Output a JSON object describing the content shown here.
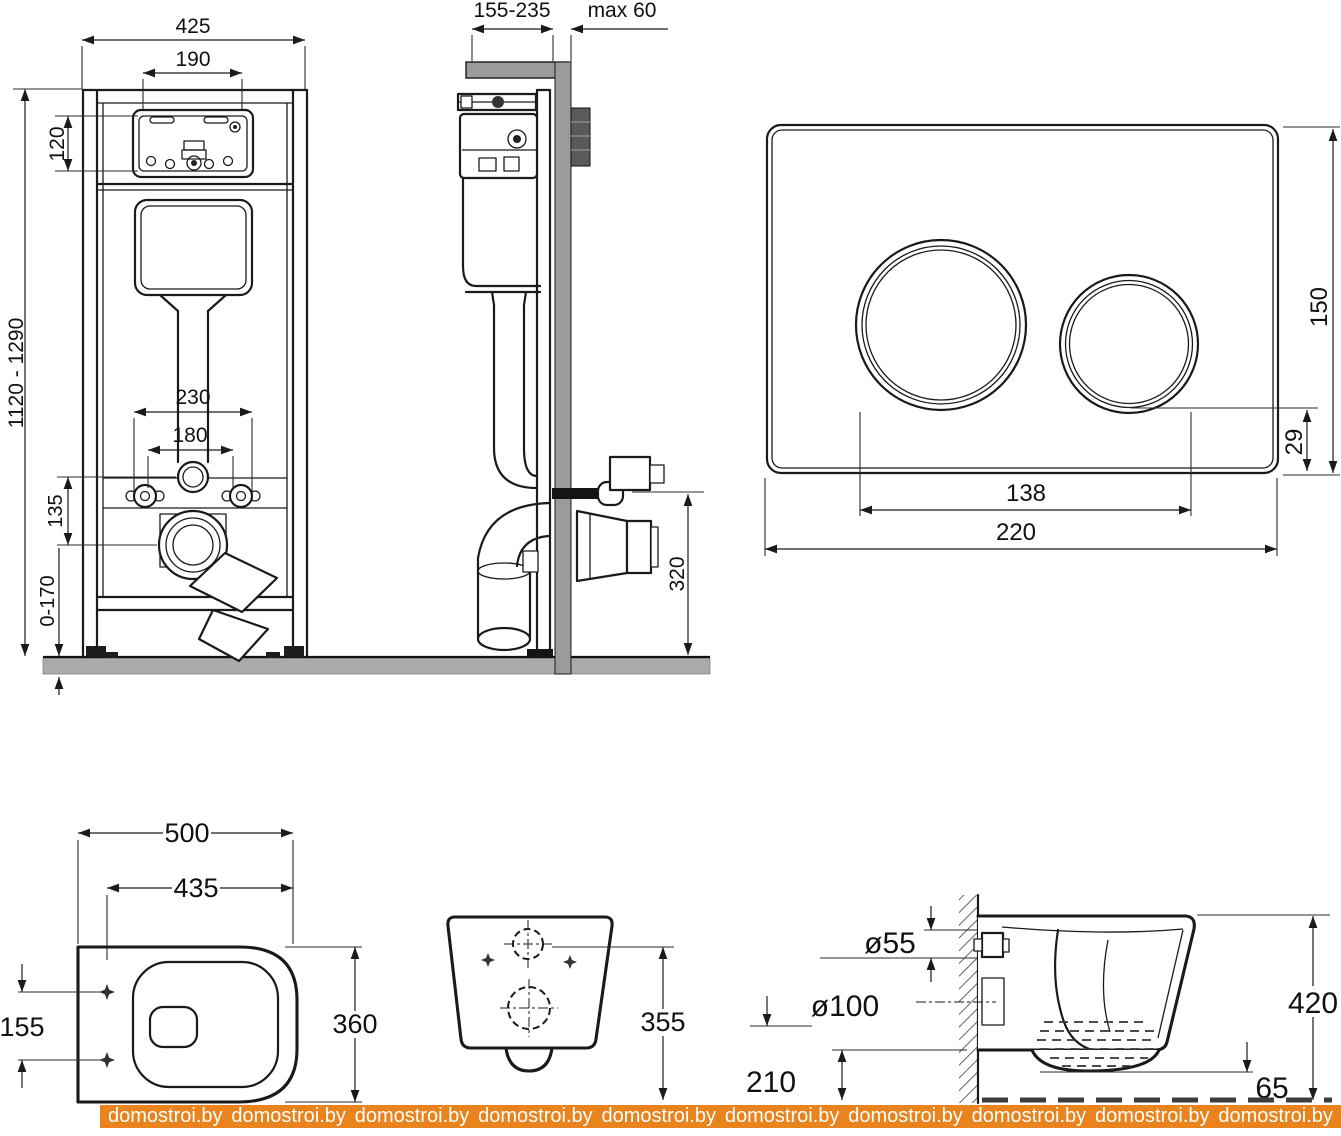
{
  "colors": {
    "line": "#1a1a1a",
    "wall_gray": "#9b9b9b",
    "floor_gray": "#ababab",
    "watermark_bg": "#e8831d",
    "watermark_text": "#ffffff"
  },
  "frame_front": {
    "width": "425",
    "service_window_width": "190",
    "service_window_height": "120",
    "height_range": "1120 - 1290",
    "fixing_spacing_outer": "230",
    "fixing_spacing_inner": "180",
    "flush_to_outlet_offset": "135",
    "leg_adjustment_range": "0-170"
  },
  "frame_side": {
    "depth_range": "155-235",
    "max_wall_thickness": "max 60",
    "outlet_height": "320"
  },
  "flush_plate": {
    "height": "150",
    "button_to_edge": "29",
    "buttons_span": "138",
    "width": "220"
  },
  "bowl_top": {
    "length": "500",
    "inner_length": "435",
    "hole_spacing": "155",
    "width": "360"
  },
  "bowl_rear": {
    "connection_height": "355"
  },
  "bowl_side": {
    "inlet_diameter": "ø55",
    "outlet_diameter": "ø100",
    "outlet_axis_height": "210",
    "depth": "420",
    "floor_gap": "65"
  },
  "watermark": {
    "text": "domostroi.by"
  }
}
